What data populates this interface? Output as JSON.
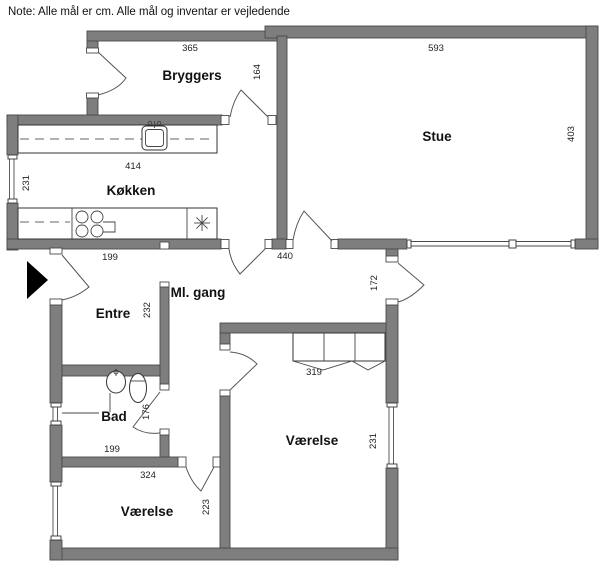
{
  "note": "Note: Alle mål er cm. Alle mål og inventar er vejledende",
  "rooms": {
    "bryggers": {
      "label": "Bryggers",
      "dim_width": "365",
      "dim_depth": "164"
    },
    "stue": {
      "label": "Stue",
      "dim_width": "593",
      "dim_depth": "403"
    },
    "kokken": {
      "label": "Køkken",
      "dim_width": "414",
      "dim_depth": "231"
    },
    "ml_gang": {
      "label": "Ml. gang",
      "dim_width": "440",
      "dim_east_wall": "172"
    },
    "entre": {
      "label": "Entre",
      "dim_width": "199",
      "dim_depth": "232"
    },
    "bad": {
      "label": "Bad",
      "dim_depth": "176",
      "dim_width": "199"
    },
    "vaerelse_sw": {
      "label": "Værelse",
      "dim_width": "324",
      "dim_depth": "223"
    },
    "vaerelse_se": {
      "label": "Værelse",
      "dim_closet": "319",
      "dim_depth": "231"
    }
  },
  "icons": {
    "entrance_arrow": "entrance-arrow"
  },
  "colors": {
    "wall": "#7e7e7e",
    "wall_edge": "#4a4a4a",
    "line": "#555555",
    "text": "#1a1a1a",
    "entrance_arrow": "#000000",
    "background": "#ffffff"
  }
}
